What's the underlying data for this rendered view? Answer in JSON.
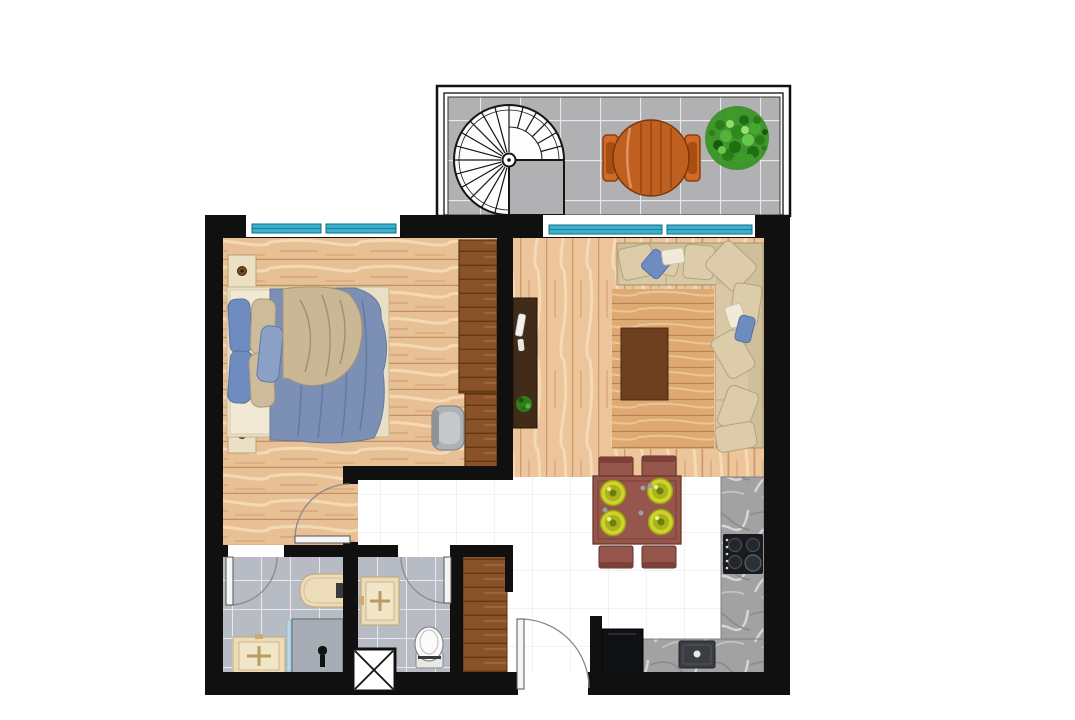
{
  "title": "apartment-floor-plan-top-view",
  "rooms": [
    {
      "name": "balcony",
      "furniture": [
        "spiral-staircase",
        "round-wood-table",
        "two-chairs",
        "potted-plant"
      ],
      "floor": "gray-tile"
    },
    {
      "name": "bedroom",
      "furniture": [
        "double-bed",
        "nightstand-top",
        "nightstand-bottom",
        "wardrobe",
        "desk",
        "desk-chair"
      ],
      "floor": "light-wood"
    },
    {
      "name": "living-room",
      "furniture": [
        "l-shaped-sofa",
        "area-rug",
        "coffee-table",
        "tv-console",
        "plant-on-console"
      ],
      "floor": "light-wood"
    },
    {
      "name": "dining-area",
      "furniture": [
        "square-dining-table",
        "four-chairs",
        "four-plates"
      ],
      "floor": "white-tile"
    },
    {
      "name": "kitchen",
      "furniture": [
        "counter-right",
        "counter-bottom",
        "cooktop-4-burners",
        "kitchen-sink",
        "refrigerator"
      ],
      "floor": "white-tile"
    },
    {
      "name": "bathroom-1",
      "furniture": [
        "bathtub",
        "washbasin",
        "shower-stall",
        "glass-panel"
      ],
      "floor": "gray-tile"
    },
    {
      "name": "bathroom-2",
      "furniture": [
        "washbasin",
        "toilet"
      ],
      "floor": "gray-tile"
    },
    {
      "name": "hallway-entry",
      "furniture": [
        "entry-door",
        "hall-closet",
        "technical-shaft"
      ],
      "floor": "white"
    }
  ],
  "openings": {
    "windows": [
      "bedroom-window-2-panes",
      "living-room-window-2-panes"
    ],
    "doors": [
      "bedroom-door",
      "bathroom-1-door",
      "bathroom-2-door",
      "entry-door"
    ]
  },
  "colors": {
    "wall": "#101010",
    "wood_light": "#e8c095",
    "wood_rug": "#dcaa72",
    "wood_dark": "#8a5228",
    "tv_console": "#402c18",
    "coffee_table": "#6e3f1e",
    "balcony_tile": "#b1b1b3",
    "bath_tile": "#b6bbc4",
    "white_floor": "#ffffff",
    "window_glass": "#3cb0cc",
    "counter_marble": "#a0a0a0",
    "stove": "#191b1f",
    "fridge": "#101114",
    "sofa": "#cfbf9d",
    "sofa_cushion": "#dccca9",
    "pillow_blue": "#6f8cc0",
    "pillow_cream": "#f0ead9",
    "bed_duvet": "#7b90b4",
    "bed_throw": "#c9b795",
    "bed_frame": "#e9dec6",
    "dining_wood": "#96564c",
    "plate_yellow": "#cdd32a",
    "sanitary_beige": "#ecdcba",
    "toilet_white": "#fbfbfb",
    "shower_gray": "#a7adb5",
    "glass_panel": "#bcd8e8",
    "patio_table": "#c06020",
    "patio_chair": "#cf6a28",
    "plant_green": "#3a9427",
    "stair_white": "#fdfdfd",
    "door_leaf": "#f5f5f5",
    "door_arc": "#8a8a8a"
  }
}
